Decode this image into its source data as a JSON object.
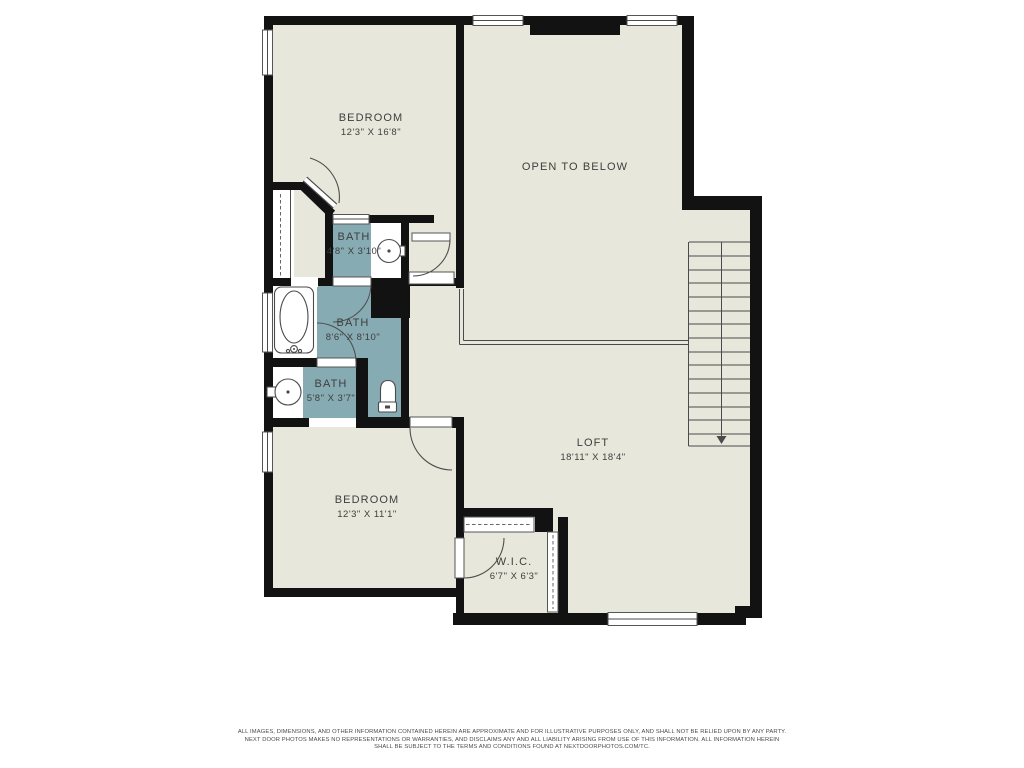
{
  "colors": {
    "floor": "#e8e7db",
    "wet": "#87abb2",
    "wall": "#121212",
    "line": "#4a4a4a",
    "text": "#3e3e3e"
  },
  "rooms": {
    "bedroom1": {
      "name": "BEDROOM",
      "dims": "12'3\" X 16'8\""
    },
    "open_below": {
      "name": "OPEN TO BELOW"
    },
    "bath_top": {
      "name": "BATH",
      "dims": "4'8\" X 3'10\""
    },
    "bath_mid": {
      "name": "BATH",
      "dims": "8'6\" X 8'10\""
    },
    "bath_low": {
      "name": "BATH",
      "dims": "5'8\" X 3'7\""
    },
    "loft": {
      "name": "LOFT",
      "dims": "18'11\" X 18'4\""
    },
    "bedroom2": {
      "name": "BEDROOM",
      "dims": "12'3\" X 11'1\""
    },
    "wic": {
      "name": "W.I.C.",
      "dims": "6'7\" X 6'3\""
    }
  },
  "disclaimer": {
    "line1": "ALL IMAGES, DIMENSIONS, AND OTHER INFORMATION CONTAINED HEREIN ARE APPROXIMATE AND FOR ILLUSTRATIVE PURPOSES ONLY, AND SHALL NOT BE RELIED UPON BY ANY PARTY.",
    "line2": "NEXT DOOR PHOTOS MAKES NO REPRESENTATIONS OR WARRANTIES, AND DISCLAIMS ANY AND ALL LIABILITY ARISING FROM USE OF THIS INFORMATION. ALL INFORMATION HEREIN",
    "line3": "SHALL BE SUBJECT TO THE TERMS AND CONDITIONS FOUND AT NEXTDOORPHOTOS.COM/TC."
  }
}
